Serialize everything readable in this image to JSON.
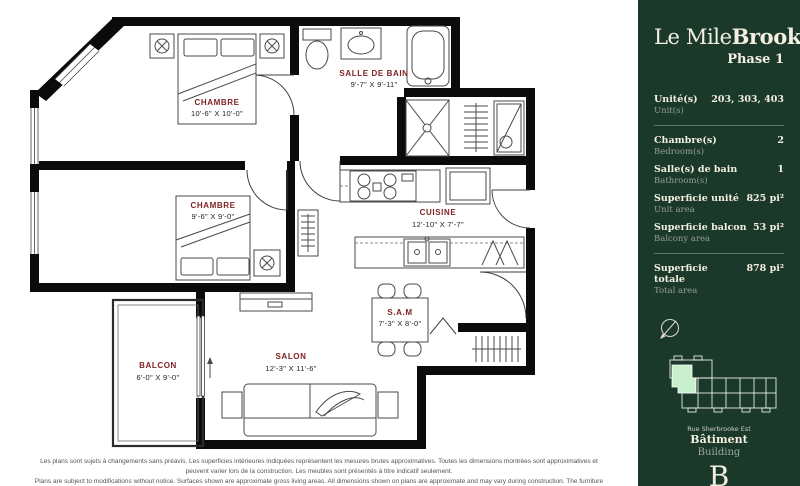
{
  "plan": {
    "rooms": [
      {
        "name": "CHAMBRE",
        "dims": "10'-6\" X 10'-0\""
      },
      {
        "name": "SALLE DE BAIN",
        "dims": "9'-7\" X 9'-11\""
      },
      {
        "name": "CHAMBRE",
        "dims": "9'-6\" X 9'-0\""
      },
      {
        "name": "CUISINE",
        "dims": "12'-10\" X 7'-7\""
      },
      {
        "name": "S.A.M",
        "dims": "7'-3\" X 8'-0\""
      },
      {
        "name": "SALON",
        "dims": "12'-3\" X 11'-6\""
      },
      {
        "name": "BALCON",
        "dims": "6'-0\" X 9'-0\""
      }
    ],
    "disclaimer_fr": "Les plans sont sujets à changements sans préavis. Les superficies intérieures indiquées représentent les mesures brutes approximatives. Toutes les dimensions montrées sont approximatives et peuvent varier lors de la construction. Les meubles sont présentés à titre indicatif seulement.",
    "disclaimer_en": "Plans are subject to modifications without notice. Surfaces shown are approximate gross living areas. All dimensions shown on plans are approximate and may vary during construction. The furniture shown is for illustration purposes only. Date : 12-03-2024"
  },
  "sidebar": {
    "brand": {
      "name_light": "Le Mile",
      "name_bold": "Brook",
      "phase": "Phase 1"
    },
    "stats": [
      {
        "label_fr": "Unité(s)",
        "label_en": "Unit(s)",
        "value": "203, 303, 403"
      },
      {
        "label_fr": "Chambre(s)",
        "label_en": "Bedroom(s)",
        "value": "2"
      },
      {
        "label_fr": "Salle(s) de bain",
        "label_en": "Bathroom(s)",
        "value": "1"
      },
      {
        "label_fr": "Superficie unité",
        "label_en": "Unit area",
        "value": "825 pi²"
      },
      {
        "label_fr": "Superficie balcon",
        "label_en": "Balcony area",
        "value": "53 pi²"
      },
      {
        "label_fr": "Superficie totale",
        "label_en": "Total area",
        "value": "878 pi²"
      }
    ],
    "map_caption": "Rue Sherbrooke Est",
    "building": {
      "label_fr": "Bâtiment",
      "label_en": "Building",
      "value": "B"
    },
    "colors": {
      "sidebar_bg": "#1a392b",
      "text_cream": "#f4efe1",
      "highlight_mint": "#c8efcb",
      "room_label_red": "#7d1f1f",
      "wall_black": "#0b0b0b"
    }
  }
}
